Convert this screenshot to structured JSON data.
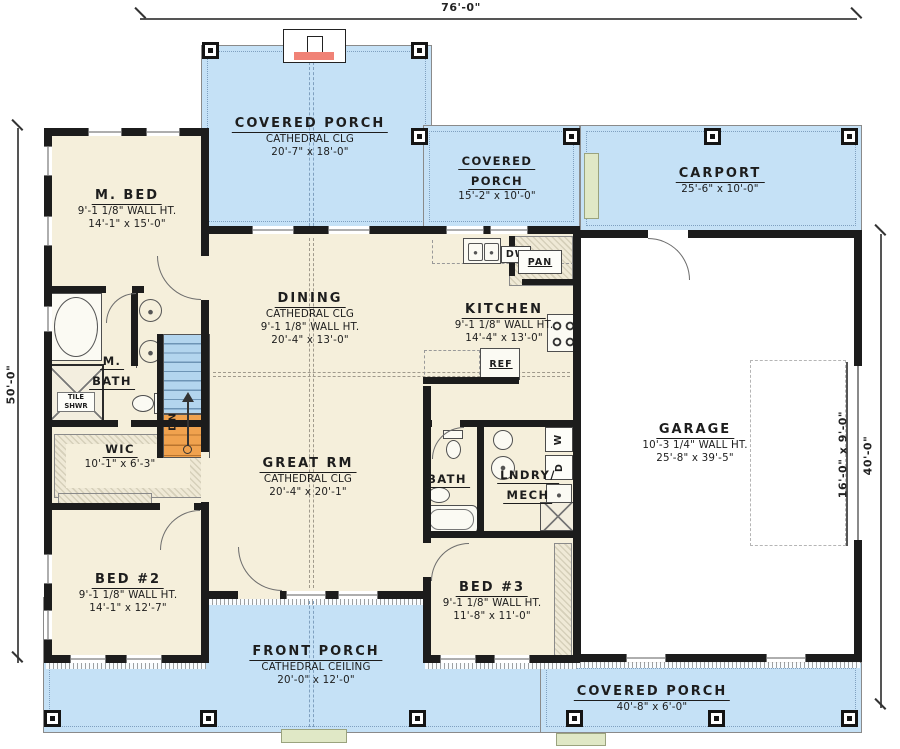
{
  "dimensions": {
    "top": "76'-0\"",
    "left": "50'-0\"",
    "right_inner": "16'-0\" x 9'-0\"",
    "right_outer": "40'-0\""
  },
  "rooms": {
    "covered_porch_top": {
      "title": "COVERED PORCH",
      "clg": "CATHEDRAL CLG",
      "size": "20'-7\" x 18'-0\""
    },
    "covered_porch_upper": {
      "title_line1": "COVERED",
      "title_line2": "PORCH",
      "size": "15'-2\" x 10'-0\""
    },
    "carport": {
      "title": "CARPORT",
      "size": "25'-6\" x 10'-0\""
    },
    "m_bed": {
      "title": "M. BED",
      "wall": "9'-1 1/8\" WALL HT.",
      "size": "14'-1\" x 15'-0\""
    },
    "m_bath": {
      "title_line1": "M.",
      "title_line2": "BATH"
    },
    "tile_shwr": {
      "line1": "TILE",
      "line2": "SHWR"
    },
    "wic": {
      "title": "WIC",
      "size": "10'-1\" x 6'-3\""
    },
    "dining": {
      "title": "DINING",
      "clg": "CATHEDRAL CLG",
      "wall": "9'-1 1/8\" WALL HT.",
      "size": "20'-4\" x 13'-0\""
    },
    "kitchen": {
      "title": "KITCHEN",
      "wall": "9'-1 1/8\" WALL HT.",
      "size": "14'-4\" x 13'-0\""
    },
    "great_rm": {
      "title": "GREAT RM",
      "clg": "CATHEDRAL CLG",
      "size": "20'-4\" x 20'-1\""
    },
    "bath": {
      "title": "BATH"
    },
    "lndry_mech": {
      "title_line1": "LNDRY/",
      "title_line2": "MECH"
    },
    "garage": {
      "title": "GARAGE",
      "wall": "10'-3 1/4\" WALL HT.",
      "size": "25'-8\" x 39'-5\""
    },
    "bed2": {
      "title": "BED #2",
      "wall": "9'-1 1/8\" WALL HT.",
      "size": "14'-1\" x 12'-7\""
    },
    "bed3": {
      "title": "BED #3",
      "wall": "9'-1 1/8\" WALL HT.",
      "size": "11'-8\" x 11'-0\""
    },
    "front_porch": {
      "title": "FRONT PORCH",
      "clg": "CATHEDRAL CEILING",
      "size": "20'-0\" x 12'-0\""
    },
    "covered_porch_bottom": {
      "title": "COVERED PORCH",
      "size": "40'-8\" x 6'-0\""
    }
  },
  "fixtures": {
    "dw": "DW",
    "pan": "PAN",
    "ref": "REF",
    "washer": "W",
    "dryer": "D",
    "stairs_down": "DN"
  },
  "colors": {
    "porch_blue": "#c5e1f6",
    "interior_cream": "#f5efdb",
    "wall_black": "#1c1c1c",
    "stair_upper_blue": "#b3d5ee",
    "stair_lower_orange": "#f0a24e",
    "step_green": "#e0e8c6",
    "hearth_red": "#f08276"
  }
}
